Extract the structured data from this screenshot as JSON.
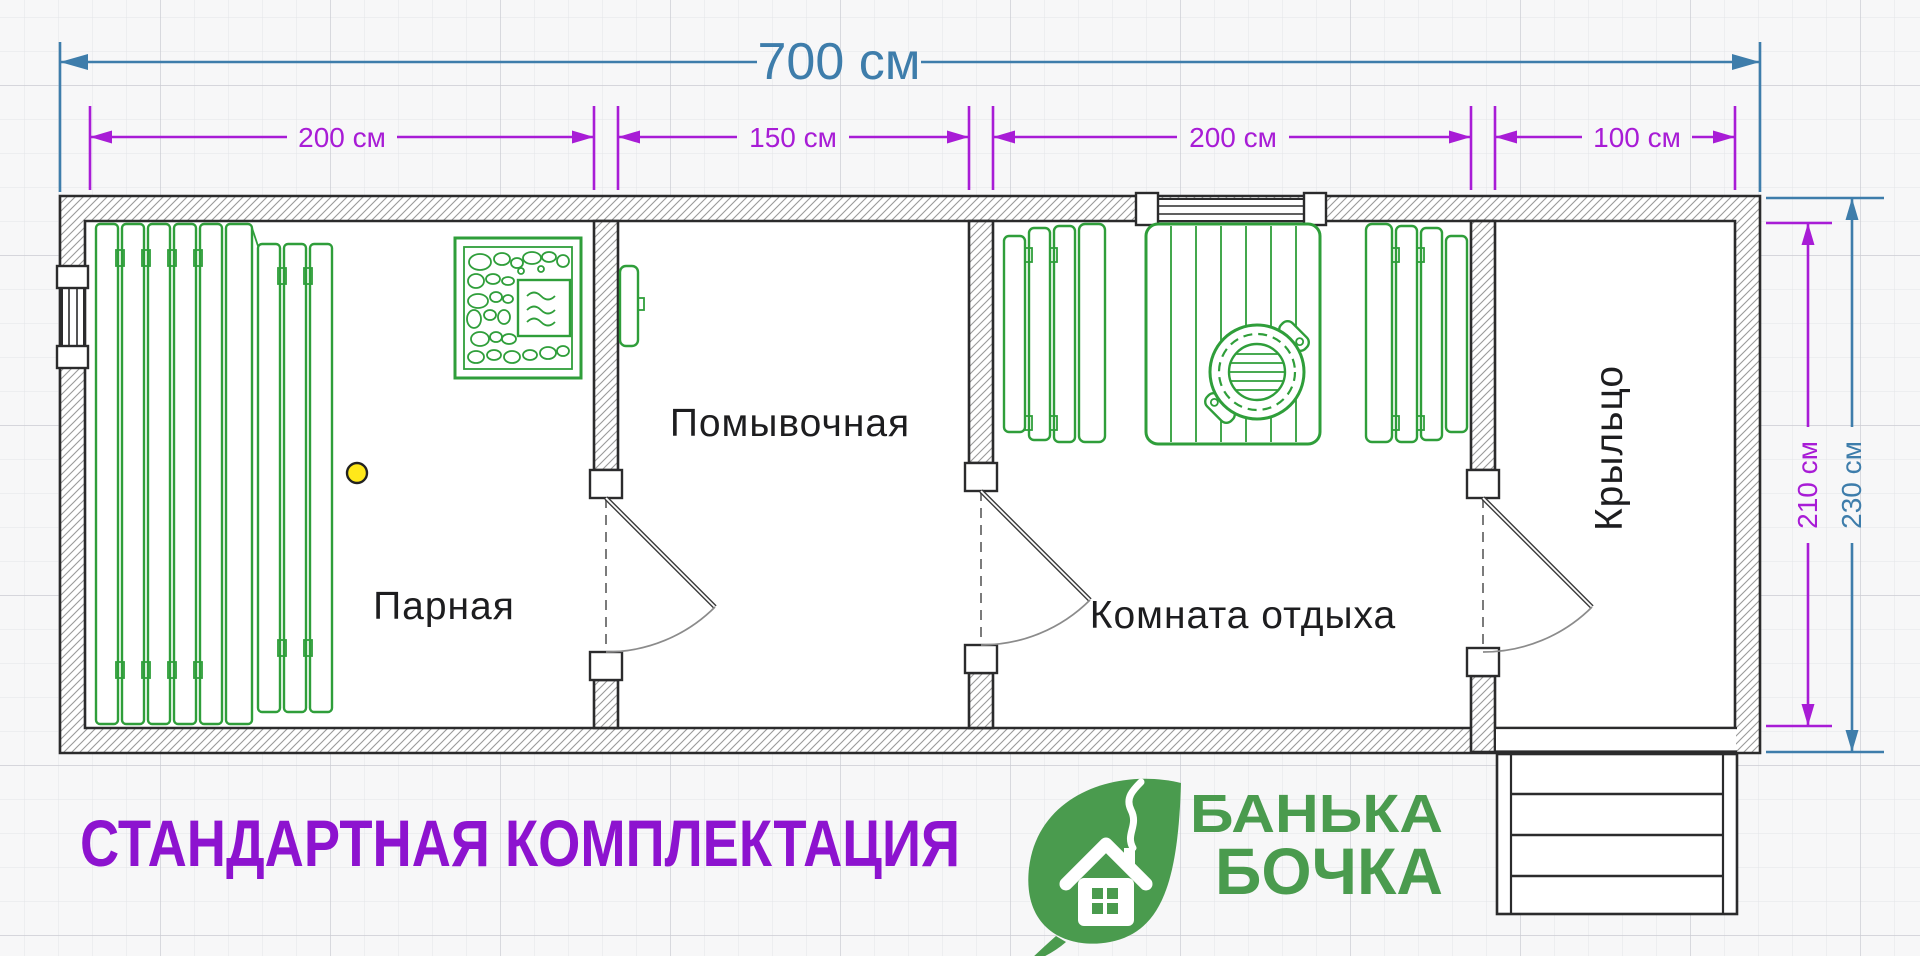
{
  "plan": {
    "total_width": {
      "label": "700 см"
    },
    "sections": [
      {
        "width_label": "200 см"
      },
      {
        "width_label": "150 см"
      },
      {
        "width_label": "200 см"
      },
      {
        "width_label": "100 см"
      }
    ],
    "heights": {
      "inner_label": "210 см",
      "outer_label": "230 см"
    },
    "rooms": {
      "steam": "Парная",
      "washing": "Помывочная",
      "lounge": "Комната отдыха",
      "porch": "Крыльцо"
    }
  },
  "footer": {
    "heading": "СТАНДАРТНАЯ КОМПЛЕКТАЦИЯ"
  },
  "logo": {
    "word1": "БАНЬКА",
    "word2": "БОЧКА"
  },
  "icons": {
    "leaf_house_logo": "green leaf with white house and smoke",
    "stove": "stone stove with firebox",
    "water_tank": "wall-mounted water tank",
    "steam_bench": "plank bench",
    "lounge_bench": "plank bench",
    "table_with_tub": "plank table with round wooden tub",
    "light_point": "yellow light point",
    "door": "swing door symbol",
    "window": "double-line window symbol",
    "porch_steps": "entry steps"
  },
  "colors": {
    "bg": "#f7f7f8",
    "grid_minor": "#e3e4e8",
    "grid_major": "#cbccd2",
    "wall_dark": "#2b2b2c",
    "text_dark": "#1d1d1f",
    "plan_green": "#2f9e3a",
    "logo_green": "#4a9b4e",
    "dim_blue": "#3e7dab",
    "dim_purple": "#a81cd6",
    "heading_purple": "#8d13cf",
    "accent_yellow": "#ffe81a"
  }
}
